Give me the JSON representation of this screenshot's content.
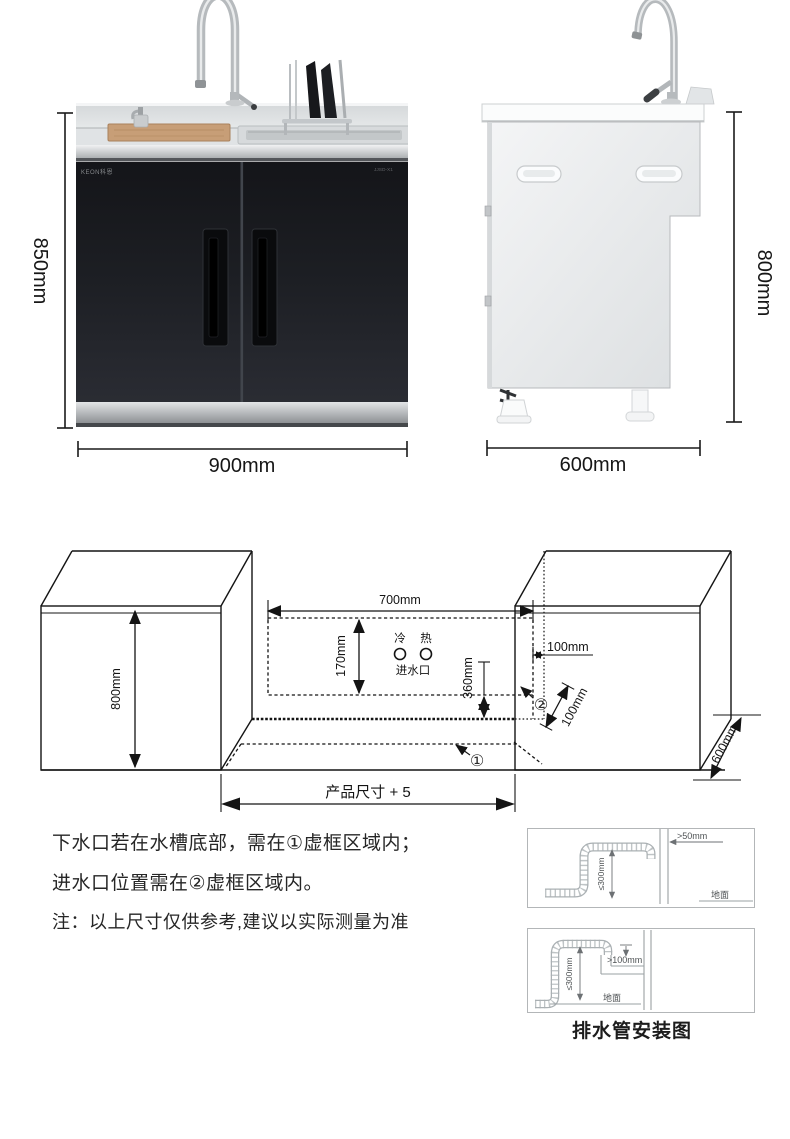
{
  "front_view": {
    "brand_logo": "KEON科恩",
    "model_label": "JJSD-X1",
    "dims": {
      "height": "850mm",
      "width": "900mm"
    }
  },
  "side_view": {
    "dims": {
      "height": "800mm",
      "depth": "600mm"
    }
  },
  "install_diagram": {
    "labels": {
      "cabinet_height": "800mm",
      "cutout_width": "700mm",
      "inlet_zone_height": "170mm",
      "inlet_zone_bottom_offset": "360mm",
      "inlet_zone_side_offset": "100mm",
      "drain_zone_depth": "100mm",
      "cabinet_depth": "600mm",
      "cutout_span": "产品尺寸 + 5",
      "cold": "冷",
      "hot": "热",
      "water_inlet": "进水口",
      "zone1": "①",
      "zone2": "②"
    }
  },
  "notes": {
    "line1": "下水口若在水槽底部，需在①虚框区域内；",
    "line2": "进水口位置需在②虚框区域内。",
    "line3": "注：以上尺寸仅供参考,建议以实际测量为准"
  },
  "drain_diagrams": {
    "caption": "排水管安装图",
    "top": {
      "gap": ">50mm",
      "height": "≤300mm",
      "ground": "地面"
    },
    "bottom": {
      "insert_depth": ">100mm",
      "height": "≤300mm",
      "ground": "地面"
    }
  }
}
